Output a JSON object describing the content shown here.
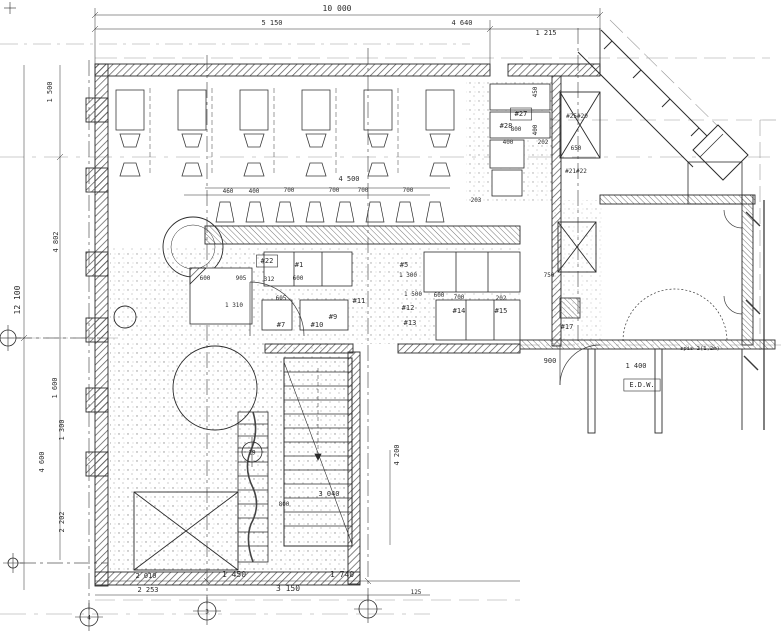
{
  "colors": {
    "ink": "#2b2b2b",
    "faint": "#8a8a8a",
    "paper": "#ffffff",
    "hatch": "#555555",
    "stipple": "#8f8f8f"
  },
  "texts": [
    {
      "name": "dim-overall-top",
      "t": "10 000",
      "x": 337,
      "y": 11,
      "r": 0,
      "s": 8,
      "cls": "dim"
    },
    {
      "name": "dim-top-left",
      "t": "5 150",
      "x": 272,
      "y": 25,
      "r": 0,
      "s": 7,
      "cls": "dim"
    },
    {
      "name": "dim-top-right",
      "t": "4 640",
      "x": 462,
      "y": 25,
      "r": 0,
      "s": 7,
      "cls": "dim"
    },
    {
      "name": "dim-top-entry",
      "t": "1 215",
      "x": 546,
      "y": 35,
      "r": 0,
      "s": 7,
      "cls": "dim"
    },
    {
      "name": "dim-overall-left",
      "t": "12 100",
      "x": 20,
      "y": 300,
      "r": -90,
      "s": 8,
      "cls": "dim"
    },
    {
      "name": "dim-left",
      "t": "1 500",
      "x": 52,
      "y": 92,
      "r": -90,
      "s": 7,
      "cls": "dim"
    },
    {
      "name": "dim-left",
      "t": "4 802",
      "x": 58,
      "y": 242,
      "r": -90,
      "s": 7,
      "cls": "dim"
    },
    {
      "name": "dim-left",
      "t": "1 600",
      "x": 57,
      "y": 388,
      "r": -90,
      "s": 7,
      "cls": "dim"
    },
    {
      "name": "dim-left",
      "t": "1 300",
      "x": 64,
      "y": 430,
      "r": -90,
      "s": 7,
      "cls": "dim"
    },
    {
      "name": "dim-left",
      "t": "4 600",
      "x": 44,
      "y": 462,
      "r": -90,
      "s": 7,
      "cls": "dim"
    },
    {
      "name": "dim-left",
      "t": "2 202",
      "x": 64,
      "y": 522,
      "r": -90,
      "s": 7,
      "cls": "dim"
    },
    {
      "name": "dim-bottom",
      "t": "2 010",
      "x": 146,
      "y": 578,
      "r": 0,
      "s": 7,
      "cls": "dim"
    },
    {
      "name": "dim-bottom",
      "t": "2 253",
      "x": 148,
      "y": 592,
      "r": 0,
      "s": 7,
      "cls": "dim"
    },
    {
      "name": "dim-bottom",
      "t": "1 450",
      "x": 234,
      "y": 577,
      "r": 0,
      "s": 8,
      "cls": "dim"
    },
    {
      "name": "dim-bottom",
      "t": "3 150",
      "x": 288,
      "y": 591,
      "r": 0,
      "s": 8,
      "cls": "dim"
    },
    {
      "name": "dim-bottom",
      "t": "1 740",
      "x": 342,
      "y": 577,
      "r": 0,
      "s": 8,
      "cls": "dim"
    },
    {
      "name": "dim-bottom",
      "t": "125",
      "x": 416,
      "y": 594,
      "r": 0,
      "s": 6,
      "cls": "dim"
    },
    {
      "name": "dim-stair-height",
      "t": "4 200",
      "x": 399,
      "y": 455,
      "r": -90,
      "s": 7,
      "cls": "dim"
    },
    {
      "name": "dim-stair-run",
      "t": "3 040",
      "x": 329,
      "y": 496,
      "r": 0,
      "s": 7,
      "cls": "dim"
    },
    {
      "name": "dim-stair",
      "t": "800",
      "x": 284,
      "y": 506,
      "r": 0,
      "s": 6,
      "cls": "dim"
    },
    {
      "name": "dim-counter-total",
      "t": "4 500",
      "x": 349,
      "y": 181,
      "r": 0,
      "s": 7,
      "cls": "dim"
    },
    {
      "name": "dim-stool",
      "t": "460",
      "x": 228,
      "y": 193,
      "r": 0,
      "s": 6,
      "cls": "dim"
    },
    {
      "name": "dim-stool",
      "t": "400",
      "x": 254,
      "y": 193,
      "r": 0,
      "s": 6,
      "cls": "dim"
    },
    {
      "name": "dim-stool",
      "t": "700",
      "x": 289,
      "y": 192,
      "r": 0,
      "s": 6,
      "cls": "dim"
    },
    {
      "name": "dim-stool",
      "t": "700",
      "x": 334,
      "y": 192,
      "r": 0,
      "s": 6,
      "cls": "dim"
    },
    {
      "name": "dim-stool",
      "t": "700",
      "x": 363,
      "y": 192,
      "r": 0,
      "s": 6,
      "cls": "dim"
    },
    {
      "name": "dim-stool",
      "t": "700",
      "x": 408,
      "y": 192,
      "r": 0,
      "s": 6,
      "cls": "dim"
    },
    {
      "name": "dim-interior",
      "t": "600",
      "x": 205,
      "y": 280,
      "r": 0,
      "s": 6,
      "cls": "dim"
    },
    {
      "name": "dim-interior",
      "t": "905",
      "x": 241,
      "y": 280,
      "r": 0,
      "s": 6,
      "cls": "dim"
    },
    {
      "name": "dim-interior",
      "t": "312",
      "x": 269,
      "y": 281,
      "r": 0,
      "s": 6,
      "cls": "dim"
    },
    {
      "name": "dim-interior",
      "t": "600",
      "x": 298,
      "y": 280,
      "r": 0,
      "s": 6,
      "cls": "dim"
    },
    {
      "name": "dim-interior",
      "t": "605",
      "x": 281,
      "y": 300,
      "r": 0,
      "s": 6,
      "cls": "dim"
    },
    {
      "name": "dim-interior",
      "t": "1 310",
      "x": 234,
      "y": 307,
      "r": 0,
      "s": 6,
      "cls": "dim"
    },
    {
      "name": "dim-interior",
      "t": "1 300",
      "x": 408,
      "y": 277,
      "r": 0,
      "s": 6,
      "cls": "dim"
    },
    {
      "name": "dim-interior",
      "t": "1 500",
      "x": 413,
      "y": 296,
      "r": 0,
      "s": 6,
      "cls": "dim"
    },
    {
      "name": "dim-interior",
      "t": "600",
      "x": 439,
      "y": 297,
      "r": 0,
      "s": 6,
      "cls": "dim"
    },
    {
      "name": "dim-interior",
      "t": "700",
      "x": 459,
      "y": 299,
      "r": 0,
      "s": 6,
      "cls": "dim"
    },
    {
      "name": "dim-interior",
      "t": "202",
      "x": 501,
      "y": 300,
      "r": 0,
      "s": 6,
      "cls": "dim"
    },
    {
      "name": "dim-interior",
      "t": "203",
      "x": 476,
      "y": 202,
      "r": 0,
      "s": 6,
      "cls": "dim"
    },
    {
      "name": "dim-interior",
      "t": "750",
      "x": 549,
      "y": 277,
      "r": 0,
      "s": 6,
      "cls": "dim"
    },
    {
      "name": "dim-kitchen",
      "t": "400",
      "x": 508,
      "y": 144,
      "r": 0,
      "s": 6,
      "cls": "dim"
    },
    {
      "name": "dim-kitchen",
      "t": "202",
      "x": 543,
      "y": 144,
      "r": 0,
      "s": 6,
      "cls": "dim"
    },
    {
      "name": "dim-kitchen",
      "t": "650",
      "x": 576,
      "y": 150,
      "r": 0,
      "s": 6,
      "cls": "dim"
    },
    {
      "name": "dim-kitchen",
      "t": "800",
      "x": 516,
      "y": 131,
      "r": 0,
      "s": 6,
      "cls": "dim"
    },
    {
      "name": "dim-kitchen",
      "t": "450",
      "x": 537,
      "y": 92,
      "r": -90,
      "s": 6,
      "cls": "dim"
    },
    {
      "name": "dim-kitchen",
      "t": "400",
      "x": 537,
      "y": 130,
      "r": -90,
      "s": 6,
      "cls": "dim"
    },
    {
      "name": "dim-door",
      "t": "900",
      "x": 550,
      "y": 363,
      "r": 0,
      "s": 7,
      "cls": "dim"
    },
    {
      "name": "dim-room",
      "t": "1 400",
      "x": 636,
      "y": 368,
      "r": 0,
      "s": 7,
      "cls": "dim"
    },
    {
      "name": "equipment-tag",
      "t": "#27",
      "x": 521,
      "y": 116,
      "r": 0,
      "s": 7,
      "cls": "tag",
      "box": true
    },
    {
      "name": "equipment-tag",
      "t": "#28",
      "x": 506,
      "y": 128,
      "r": 0,
      "s": 7,
      "cls": "tag"
    },
    {
      "name": "equipment-tag",
      "t": "#25#20",
      "x": 577,
      "y": 118,
      "r": 0,
      "s": 6,
      "cls": "tag"
    },
    {
      "name": "equipment-tag",
      "t": "#21#22",
      "x": 576,
      "y": 173,
      "r": 0,
      "s": 6,
      "cls": "tag"
    },
    {
      "name": "equipment-tag",
      "t": "#22",
      "x": 267,
      "y": 263,
      "r": 0,
      "s": 7,
      "cls": "tag",
      "box": true
    },
    {
      "name": "equipment-tag",
      "t": "#1",
      "x": 299,
      "y": 267,
      "r": 0,
      "s": 7,
      "cls": "tag"
    },
    {
      "name": "equipment-tag",
      "t": "#5",
      "x": 404,
      "y": 267,
      "r": 0,
      "s": 7,
      "cls": "tag"
    },
    {
      "name": "equipment-tag",
      "t": "#12",
      "x": 408,
      "y": 310,
      "r": 0,
      "s": 7,
      "cls": "tag"
    },
    {
      "name": "equipment-tag",
      "t": "#13",
      "x": 410,
      "y": 325,
      "r": 0,
      "s": 7,
      "cls": "tag"
    },
    {
      "name": "equipment-tag",
      "t": "#11",
      "x": 359,
      "y": 303,
      "r": 0,
      "s": 7,
      "cls": "tag"
    },
    {
      "name": "equipment-tag",
      "t": "#7",
      "x": 281,
      "y": 327,
      "r": 0,
      "s": 7,
      "cls": "tag"
    },
    {
      "name": "equipment-tag",
      "t": "#10",
      "x": 317,
      "y": 327,
      "r": 0,
      "s": 7,
      "cls": "tag"
    },
    {
      "name": "equipment-tag",
      "t": "#9",
      "x": 333,
      "y": 319,
      "r": 0,
      "s": 7,
      "cls": "tag"
    },
    {
      "name": "equipment-tag",
      "t": "#14",
      "x": 459,
      "y": 313,
      "r": 0,
      "s": 7,
      "cls": "tag"
    },
    {
      "name": "equipment-tag",
      "t": "#15",
      "x": 501,
      "y": 313,
      "r": 0,
      "s": 7,
      "cls": "tag"
    },
    {
      "name": "equipment-tag",
      "t": "#17",
      "x": 567,
      "y": 329,
      "r": 0,
      "s": 7,
      "cls": "tag"
    },
    {
      "name": "room-label-edw",
      "t": "E.D.W.",
      "x": 642,
      "y": 387,
      "r": 0,
      "s": 7,
      "cls": "ann",
      "box": true
    },
    {
      "name": "annotation-pantry",
      "t": "spis 2(1,2m)",
      "x": 700,
      "y": 350,
      "r": 0,
      "s": 5.5,
      "cls": "ann"
    }
  ],
  "grid_markers": [
    {
      "x": 8,
      "y": 338,
      "r": 8,
      "label": ""
    },
    {
      "x": 13,
      "y": 563,
      "r": 5,
      "label": ""
    },
    {
      "x": 89,
      "y": 617,
      "r": 9,
      "label": "4"
    },
    {
      "x": 207,
      "y": 611,
      "r": 9,
      "label": "3"
    },
    {
      "x": 368,
      "y": 609,
      "r": 9,
      "label": ""
    },
    {
      "x": 252,
      "y": 452,
      "r": 10,
      "label": "19"
    },
    {
      "x": 10,
      "y": 8,
      "r": 0,
      "label": ""
    }
  ]
}
